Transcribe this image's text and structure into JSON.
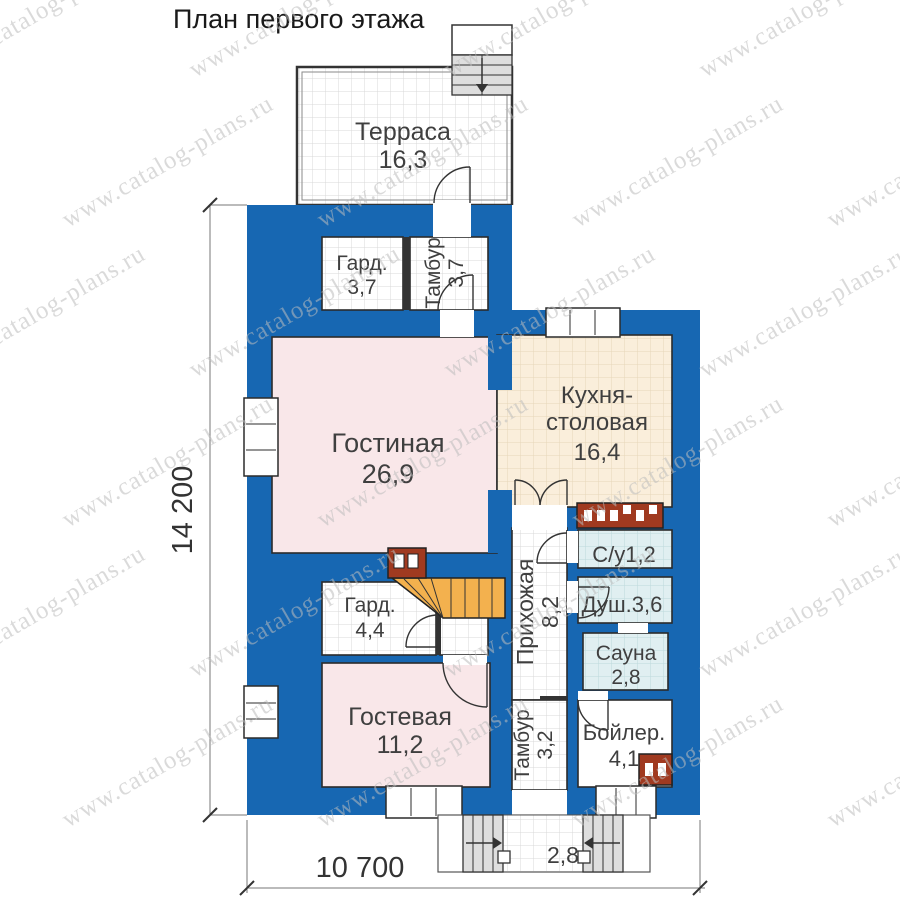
{
  "title": "План первого этажа",
  "watermark": {
    "text": "www.catalog-plans.ru"
  },
  "dimensions": {
    "height": "14 200",
    "width": "10 700"
  },
  "rooms": {
    "terrace": {
      "name": "Терраса",
      "area": "16,3"
    },
    "wardrobe1": {
      "name": "Гард.",
      "area": "3,7"
    },
    "tambour1": {
      "name": "Тамбур",
      "area": "3,7"
    },
    "living": {
      "name": "Гостиная",
      "area": "26,9"
    },
    "kitchen": {
      "name_line1": "Кухня-",
      "name_line2": "столовая",
      "area": "16,4"
    },
    "wc": {
      "name": "С/у",
      "area": "1,2"
    },
    "shower": {
      "name": "Душ.",
      "area": "3,6"
    },
    "hallway": {
      "name": "Прихожая",
      "area": "8,2"
    },
    "wardrobe2": {
      "name": "Гард.",
      "area": "4,4"
    },
    "sauna": {
      "name": "Сауна",
      "area": "2,8"
    },
    "guest": {
      "name": "Гостевая",
      "area": "11,2"
    },
    "tambour2": {
      "name": "Тамбур",
      "area": "3,2"
    },
    "boiler": {
      "name": "Бойлер.",
      "area": "4,1"
    },
    "porch": {
      "area": "2,8"
    }
  },
  "colors": {
    "wall": "#1767b2",
    "room_pink": "#f9e7e9",
    "kitchen_beige": "#faeedb",
    "wet_blue": "#e0eff1",
    "stair_orange": "#f3b14e",
    "brick_red": "#a03a20",
    "watermark": "#bdbdbd"
  }
}
